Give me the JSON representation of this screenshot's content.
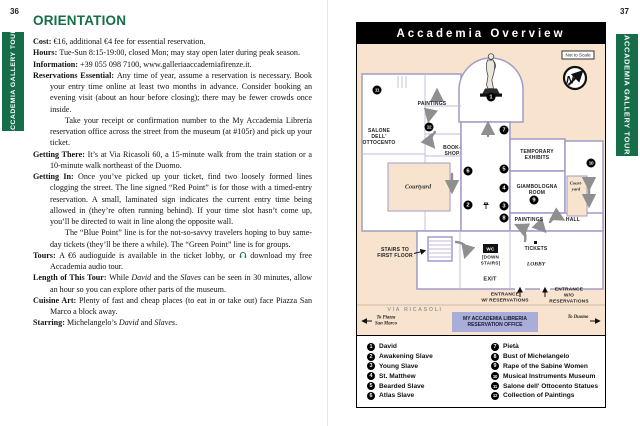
{
  "colors": {
    "accent_green": "#156e47",
    "map_background_peach": "#f8e3cf",
    "plan_wall_purple": "#a29bc7",
    "arrow_gray": "#8f8f8f",
    "office_box_purple": "#a9aed9",
    "banner_black": "#000000"
  },
  "icons": {
    "headphones": "headphones-icon",
    "compass": "north-arrow-icon",
    "statue": "david-statue-icon"
  },
  "left": {
    "page_number": "36",
    "sidebar_label": "ACCADEMIA GALLERY TOUR",
    "heading": "ORIENTATION",
    "entries": {
      "cost": [
        {
          "t": "Cost: ",
          "b": 1
        },
        {
          "t": "€16, additional €4 fee for essential reservation."
        }
      ],
      "hours": [
        {
          "t": "Hours: ",
          "b": 1
        },
        {
          "t": "Tue-Sun 8:15-19:00, closed Mon; may stay open later during peak season."
        }
      ],
      "information": [
        {
          "t": "Information: ",
          "b": 1
        },
        {
          "t": "+39 055 098 7100, www.galleriaaccademiafirenze.it."
        }
      ],
      "reservations": [
        {
          "t": "Reservations Essential: ",
          "b": 1
        },
        {
          "t": "Any time of year, assume a reservation is necessary. Book your entry time online at least two months in advance. Consider booking an evening visit (about an hour before closing); there may be fewer crowds once inside."
        }
      ],
      "reservations_cont": [
        {
          "t": "Take your receipt or confirmation number to the My Accademia Libreria reservation office across the street from the museum (at #105r) and pick up your ticket."
        }
      ],
      "getting_there": [
        {
          "t": "Getting There: ",
          "b": 1
        },
        {
          "t": "It’s at Via Ricasoli 60, a 15-minute walk from the train station or a 10-minute walk northeast of the Duomo."
        }
      ],
      "getting_in": [
        {
          "t": "Getting In: ",
          "b": 1
        },
        {
          "t": "Once you’ve picked up your ticket, find two loosely formed lines clogging the street. The line signed “Red Point” is for those with a timed-entry reservation. A small, laminated sign indicates the current entry time being allowed in (they’re often running behind). If your time slot hasn’t come up, you’ll be directed to wait in line along the opposite wall."
        }
      ],
      "getting_in_cont": [
        {
          "t": "The “Blue Point” line is for the not-so-savvy travelers hoping to buy same-day tickets (they’ll be there a while). The “Green Point” line is for groups."
        }
      ],
      "tours_pre": [
        {
          "t": "Tours: ",
          "b": 1
        },
        {
          "t": "A €6 audioguide is available in the ticket lobby, or "
        }
      ],
      "tours_post": [
        {
          "t": " download my free Accademia audio tour."
        }
      ],
      "length": [
        {
          "t": "Length of This Tour: ",
          "b": 1
        },
        {
          "t": "While "
        },
        {
          "t": "David",
          "i": 1
        },
        {
          "t": " and the "
        },
        {
          "t": "Slaves",
          "i": 1
        },
        {
          "t": " can be seen in 30 minutes, allow an hour so you can explore other parts of the museum."
        }
      ],
      "cuisine": [
        {
          "t": "Cuisine Art: ",
          "b": 1
        },
        {
          "t": "Plenty of fast and cheap places (to eat in or take out) face Piazza San Marco a block away."
        }
      ],
      "starring": [
        {
          "t": "Starring: ",
          "b": 1
        },
        {
          "t": "Michelangelo’s "
        },
        {
          "t": "David",
          "i": 1
        },
        {
          "t": " and "
        },
        {
          "t": "Slaves",
          "i": 1
        },
        {
          "t": "."
        }
      ]
    }
  },
  "right": {
    "page_number": "37",
    "sidebar_label": "ACCADEMIA GALLERY TOUR",
    "map": {
      "title": "Accademia Overview",
      "scale_note": "Not to Scale",
      "compass": "N",
      "markers": [
        "1",
        "2",
        "3",
        "4",
        "5",
        "6",
        "7",
        "8",
        "9",
        "10",
        "11",
        "12"
      ],
      "labels": {
        "paintings_upper": "PAINTINGS",
        "salone": "SALONE\nDELL'\nOTTOCENTO",
        "bookshop": "BOOK-\nSHOP",
        "courtyard_left": "Courtyard",
        "temporary_exhibits": "TEMPORARY\nEXHIBITS",
        "giambologna": "GIAMBOLOGNA\nROOM",
        "courtyard_right": "Court-\nyard",
        "hall": "HALL",
        "paintings_lower": "PAINTINGS",
        "stairs": "STAIRS TO\nFIRST FLOOR",
        "wc": "WC",
        "down_stairs": "[DOWN\nSTAIRS]",
        "tickets": "TICKETS",
        "lobby": "LOBBY",
        "exit": "EXIT",
        "entrance_with": "ENTRANCE\nW/ RESERVATIONS",
        "entrance_without": "ENTRANCE\nW/O RESERVATIONS",
        "via_ricasoli": "VIA RICASOLI",
        "to_piazza": "To Piazza\nSan Marco",
        "office": "MY ACCADEMIA LIBRERIA\nRESERVATION OFFICE",
        "to_duomo": "To Duomo"
      },
      "legend": {
        "items": [
          {
            "num": "1",
            "label": "David"
          },
          {
            "num": "2",
            "label": "Awakening Slave"
          },
          {
            "num": "3",
            "label": "Young Slave"
          },
          {
            "num": "4",
            "label": "St. Matthew"
          },
          {
            "num": "5",
            "label": "Bearded Slave"
          },
          {
            "num": "6",
            "label": "Atlas Slave"
          },
          {
            "num": "7",
            "label": "Pietà"
          },
          {
            "num": "8",
            "label": "Bust of Michelangelo"
          },
          {
            "num": "9",
            "label": "Rape of the Sabine Women"
          },
          {
            "num": "10",
            "label": "Musical Instruments Museum"
          },
          {
            "num": "11",
            "label": "Salone dell' Ottocento Statues"
          },
          {
            "num": "12",
            "label": "Collection of Paintings"
          }
        ]
      }
    }
  }
}
